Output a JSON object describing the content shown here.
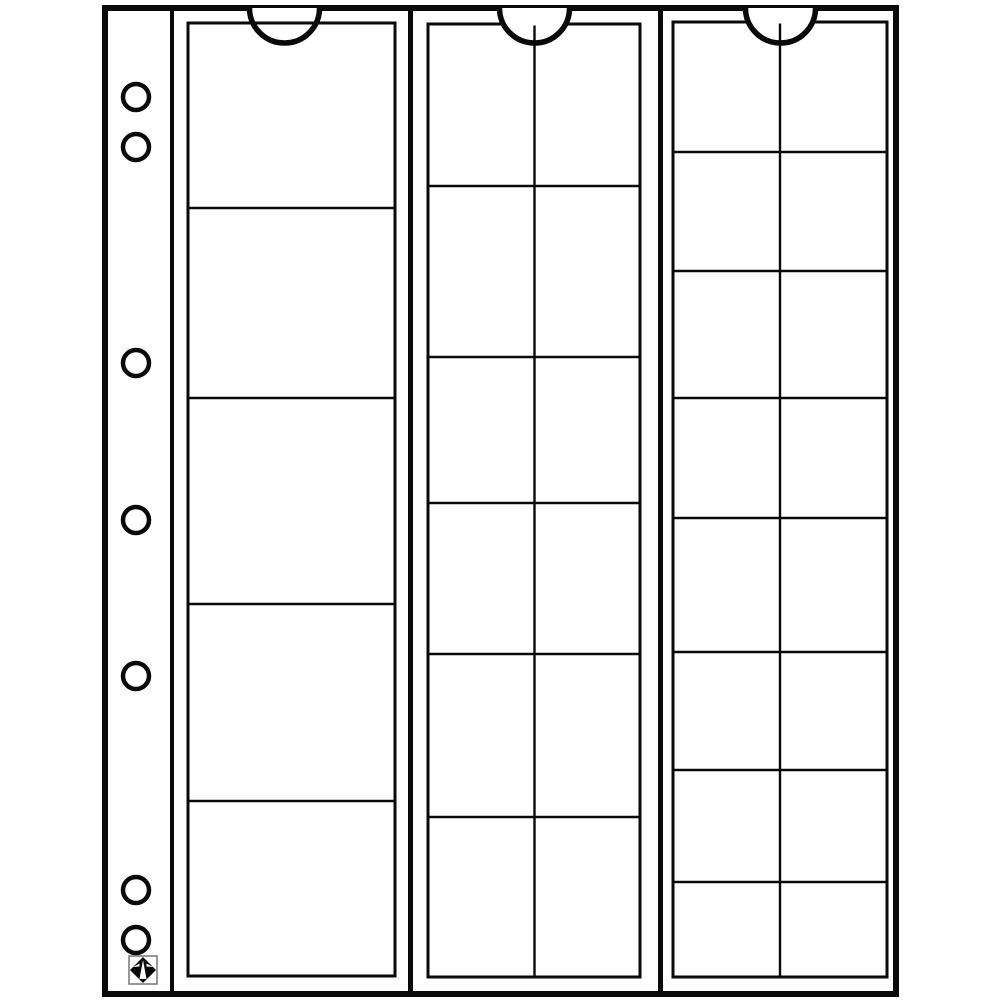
{
  "title": "Coin pocket sheet line drawing",
  "colors": {
    "background": "#ffffff",
    "line": "#0a0a0a",
    "logo_frame": "#777777"
  },
  "sheet": {
    "page_outline": {
      "x1": 105,
      "y1": 8,
      "x2": 896,
      "y2": 994,
      "stroke": 6
    },
    "binding_strip": {
      "divider_x": 172,
      "holes": {
        "count": 7,
        "center_x": 136,
        "radius": 13,
        "ring_stroke": 4.5,
        "centers_y": [
          97,
          147,
          363,
          520,
          676,
          890,
          940
        ]
      }
    },
    "section_dividers_x": [
      410.5,
      660.5
    ],
    "notch_radius": 35,
    "notch_stroke": 5.5,
    "sections": [
      {
        "id": "large-pockets",
        "rows": 5,
        "cols": 1,
        "pockets": 5,
        "panel": [
          188,
          23,
          395,
          976
        ],
        "row_lines": [
          208,
          398,
          604,
          801
        ],
        "col_lines": [],
        "notch_cx": 284.5,
        "panel_over_notch": true
      },
      {
        "id": "medium-pockets",
        "rows": 6,
        "cols": 2,
        "pockets": 12,
        "panel": [
          428,
          24,
          640,
          977
        ],
        "row_lines": [
          186,
          357,
          503,
          654,
          817
        ],
        "col_lines": [
          534.5
        ],
        "notch_cx": 534.5,
        "panel_over_notch": false
      },
      {
        "id": "small-pockets",
        "rows": 8,
        "cols": 2,
        "pockets": 16,
        "panel": [
          673,
          22,
          887,
          977
        ],
        "row_lines": [
          152,
          271,
          398,
          518,
          652,
          770,
          882
        ],
        "col_lines": [
          780
        ],
        "notch_cx": 780.5,
        "panel_over_notch": false
      }
    ],
    "total_pockets": 33,
    "logo": {
      "name": "lighthouse-diamond-logo",
      "box": [
        129,
        956,
        28,
        28
      ]
    }
  }
}
